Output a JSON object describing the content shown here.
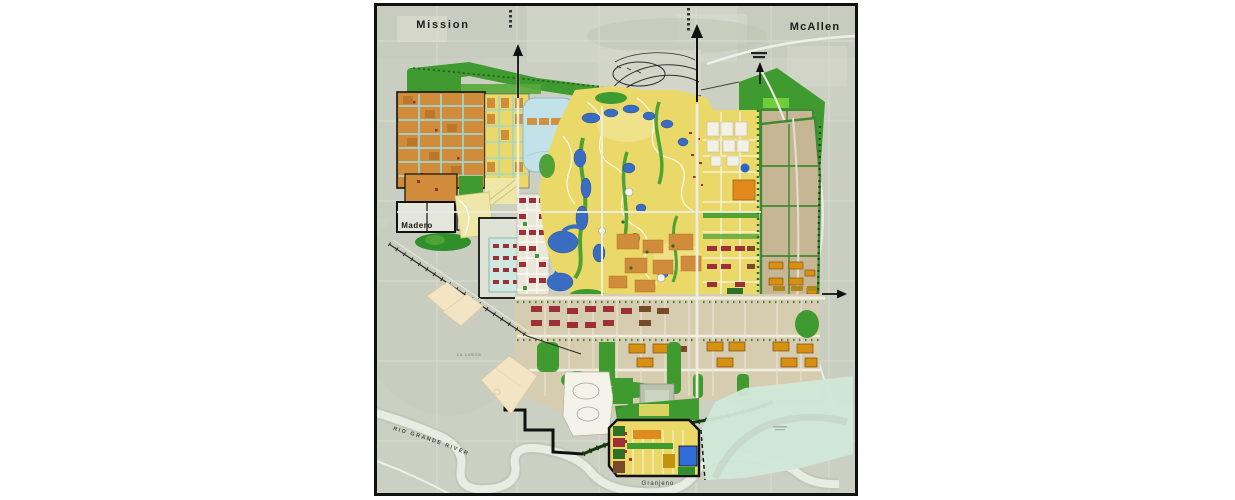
{
  "page": {
    "background_color": "#ffffff"
  },
  "map": {
    "frame": {
      "border_color": "#111111"
    },
    "labels": {
      "city_top_left": "Mission",
      "city_top_right": "McAllen",
      "community_west": "Madero",
      "community_south": "Granjeno",
      "community_southwest": "La Lomita",
      "river": "RIO GRANDE RIVER"
    },
    "palette": {
      "aerial_background": "#ccd0c3",
      "parks_golf_green": "#3f9b2f",
      "tree_green_dark": "#2c6e22",
      "residential_yellow": "#ead968",
      "residential_orange": "#d08c3a",
      "civic_red": "#9c2f38",
      "water_blue": "#3a6cc2",
      "lagoon_pale_blue": "#c2e2ea",
      "teal_streets": "#9fd4cc",
      "large_parcel_tan": "#c7b693",
      "south_district_tan": "#d6cdb0",
      "southeast_teal": "#d0e7d8",
      "beige_tracts": "#f3e5c4",
      "gold_buildings": "#d89010",
      "street_white": "#f2efe4",
      "boundary_black": "#111111"
    },
    "symbols": {
      "north_arrow_count": 2,
      "east_arrow_count": 1
    }
  }
}
